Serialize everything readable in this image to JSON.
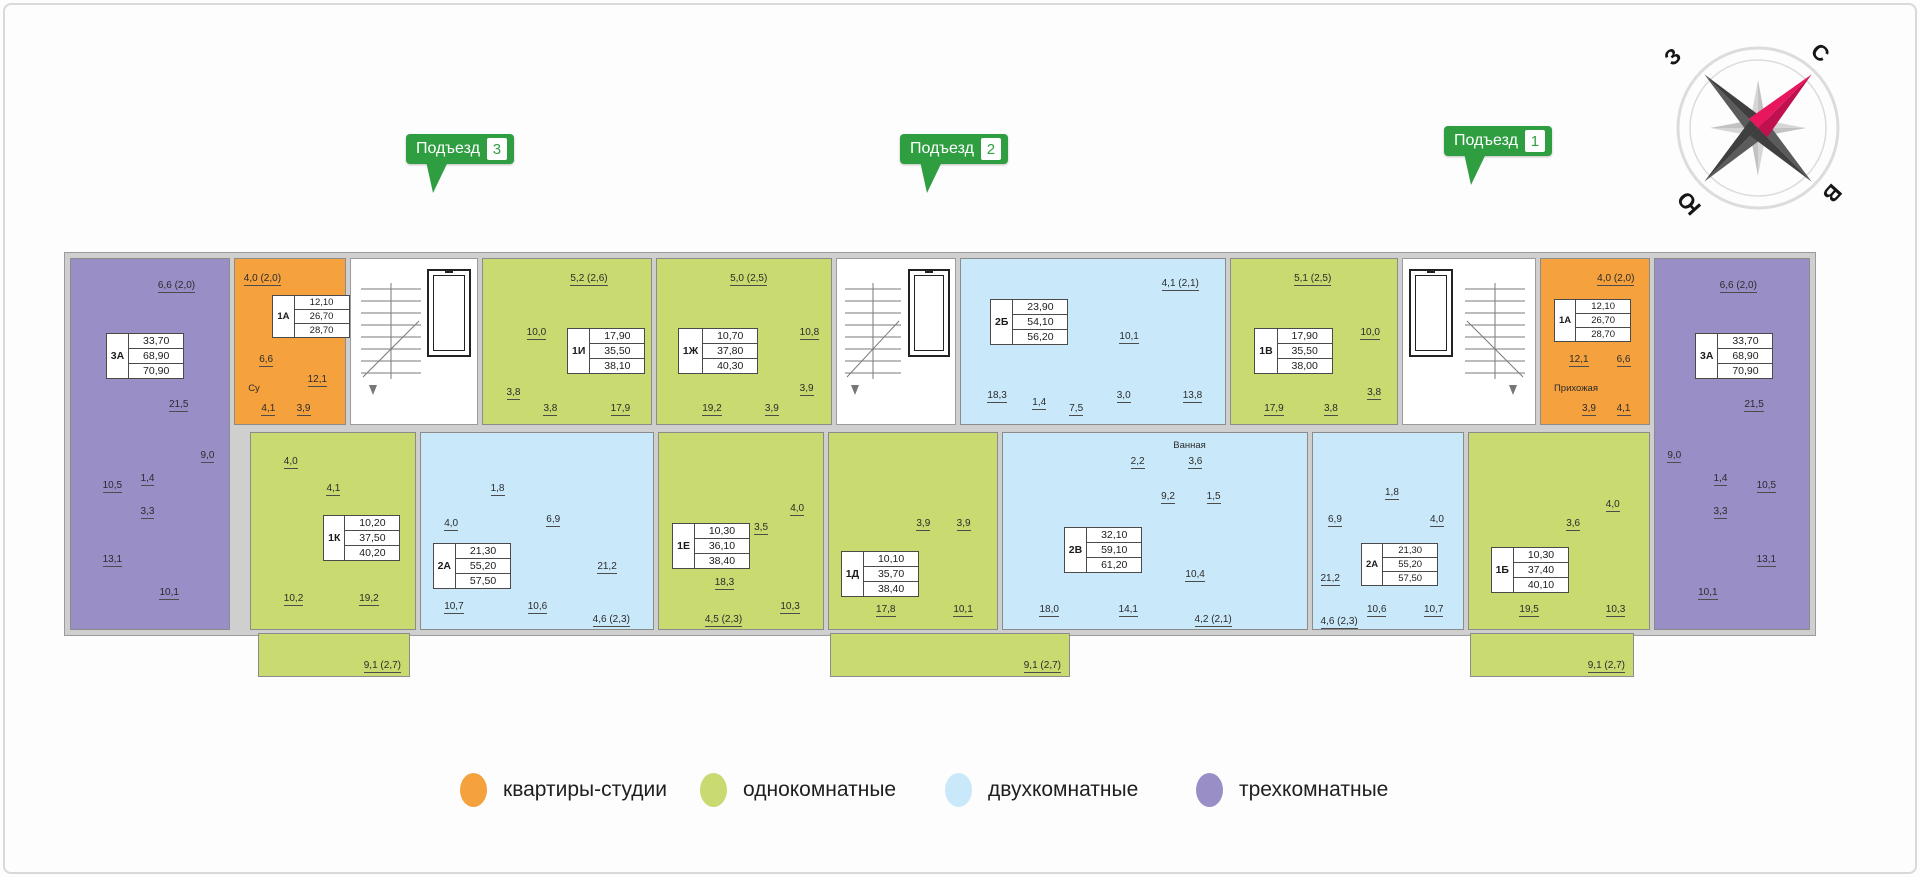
{
  "entrances": [
    {
      "label": "Подъезд",
      "number": "3"
    },
    {
      "label": "Подъезд",
      "number": "2"
    },
    {
      "label": "Подъезд",
      "number": "1"
    }
  ],
  "compass": {
    "north": "С",
    "east": "В",
    "south": "Ю",
    "west": "З",
    "needle_color": "#e8175d",
    "dark_color": "#4a4a4a",
    "light_color": "#cdcdcd"
  },
  "legend": [
    {
      "label": "квартиры-студии",
      "color": "#F4A13E"
    },
    {
      "label": "однокомнатные",
      "color": "#C8DA70"
    },
    {
      "label": "двухкомнатные",
      "color": "#C9E9FB"
    },
    {
      "label": "трехкомнатные",
      "color": "#9A8EC6"
    }
  ],
  "apartments": [
    {
      "id": "3А",
      "kind": "трехкомнатная",
      "color": "#9A8EC6",
      "living": "33,70",
      "area": "68,90",
      "total": "70,90",
      "rooms": [
        "6,6 (2,0)",
        "21,5",
        "9,0",
        "1,4",
        "3,3",
        "10,5",
        "13,1",
        "10,1"
      ]
    },
    {
      "id": "1А",
      "kind": "квартира-студия",
      "color": "#F4A13E",
      "living": "12,10",
      "area": "26,70",
      "total": "28,70",
      "rooms": [
        "4,0 (2,0)",
        "6,6",
        "12,1",
        "4,1",
        "3,9"
      ],
      "note": "Су"
    },
    {
      "id": "1И",
      "kind": "однокомнатная",
      "color": "#C8DA70",
      "living": "17,90",
      "area": "35,50",
      "total": "38,10",
      "rooms": [
        "5,2 (2,6)",
        "10,0",
        "3,8",
        "3,8",
        "17,9"
      ]
    },
    {
      "id": "1Ж",
      "kind": "однокомнатная",
      "color": "#C8DA70",
      "living": "10,70",
      "area": "37,80",
      "total": "40,30",
      "rooms": [
        "5,0 (2,5)",
        "10,8",
        "3,9",
        "3,9",
        "19,2"
      ]
    },
    {
      "id": "2Б",
      "kind": "двухкомнатная",
      "color": "#C9E9FB",
      "living": "23,90",
      "area": "54,10",
      "total": "56,20",
      "rooms": [
        "4,1 (2,1)",
        "10,1",
        "13,8",
        "18,3",
        "1,4",
        "7,5",
        "3,0"
      ]
    },
    {
      "id": "1В",
      "kind": "однокомнатная",
      "color": "#C8DA70",
      "living": "17,90",
      "area": "35,50",
      "total": "38,00",
      "rooms": [
        "5,1 (2,5)",
        "10,0",
        "3,8",
        "3,8",
        "17,9"
      ]
    },
    {
      "id": "1А",
      "kind": "квартира-студия",
      "color": "#F4A13E",
      "living": "12,10",
      "area": "26,70",
      "total": "28,70",
      "rooms": [
        "4,0 (2,0)",
        "12,1",
        "6,6",
        "3,9",
        "4,1"
      ],
      "note": "Прихожая"
    },
    {
      "id": "3А",
      "kind": "трехкомнатная",
      "color": "#9A8EC6",
      "living": "33,70",
      "area": "68,90",
      "total": "70,90",
      "rooms": [
        "6,6 (2,0)",
        "21,5",
        "9,0",
        "1,4",
        "3,3",
        "10,5",
        "13,1",
        "10,1"
      ]
    },
    {
      "id": "1К",
      "kind": "однокомнатная",
      "color": "#C8DA70",
      "living": "10,20",
      "area": "37,50",
      "total": "40,20",
      "rooms": [
        "4,0",
        "4,1",
        "10,2",
        "19,2"
      ],
      "balcony": "9,1 (2,7)"
    },
    {
      "id": "2А",
      "kind": "двухкомнатная",
      "color": "#C9E9FB",
      "living": "21,30",
      "area": "55,20",
      "total": "57,50",
      "rooms": [
        "1,8",
        "4,0",
        "6,9",
        "21,2",
        "10,7",
        "10,6",
        "4,6 (2,3)"
      ]
    },
    {
      "id": "1Е",
      "kind": "однокомнатная",
      "color": "#C8DA70",
      "living": "10,30",
      "area": "36,10",
      "total": "38,40",
      "rooms": [
        "4,0",
        "3,5",
        "18,3",
        "10,3",
        "4,5 (2,3)"
      ]
    },
    {
      "id": "1Д",
      "kind": "однокомнатная",
      "color": "#C8DA70",
      "living": "10,10",
      "area": "35,70",
      "total": "38,40",
      "rooms": [
        "3,9",
        "3,9",
        "17,8",
        "10,1"
      ],
      "balcony": "9,1 (2,7)"
    },
    {
      "id": "2В",
      "kind": "двухкомнатная",
      "color": "#C9E9FB",
      "living": "32,10",
      "area": "59,10",
      "total": "61,20",
      "rooms": [
        "2,2",
        "3,6",
        "9,2",
        "1,5",
        "10,4",
        "18,0",
        "14,1",
        "4,2 (2,1)"
      ],
      "note": "Ванная"
    },
    {
      "id": "2А",
      "kind": "двухкомнатная",
      "color": "#C9E9FB",
      "living": "21,30",
      "area": "55,20",
      "total": "57,50",
      "rooms": [
        "1,8",
        "6,9",
        "4,0",
        "21,2",
        "10,6",
        "10,7",
        "4,6 (2,3)"
      ]
    },
    {
      "id": "1Б",
      "kind": "однокомнатная",
      "color": "#C8DA70",
      "living": "10,30",
      "area": "37,40",
      "total": "40,10",
      "rooms": [
        "4,0",
        "3,6",
        "19,5",
        "10,3"
      ],
      "balcony": "9,1 (2,7)"
    }
  ]
}
